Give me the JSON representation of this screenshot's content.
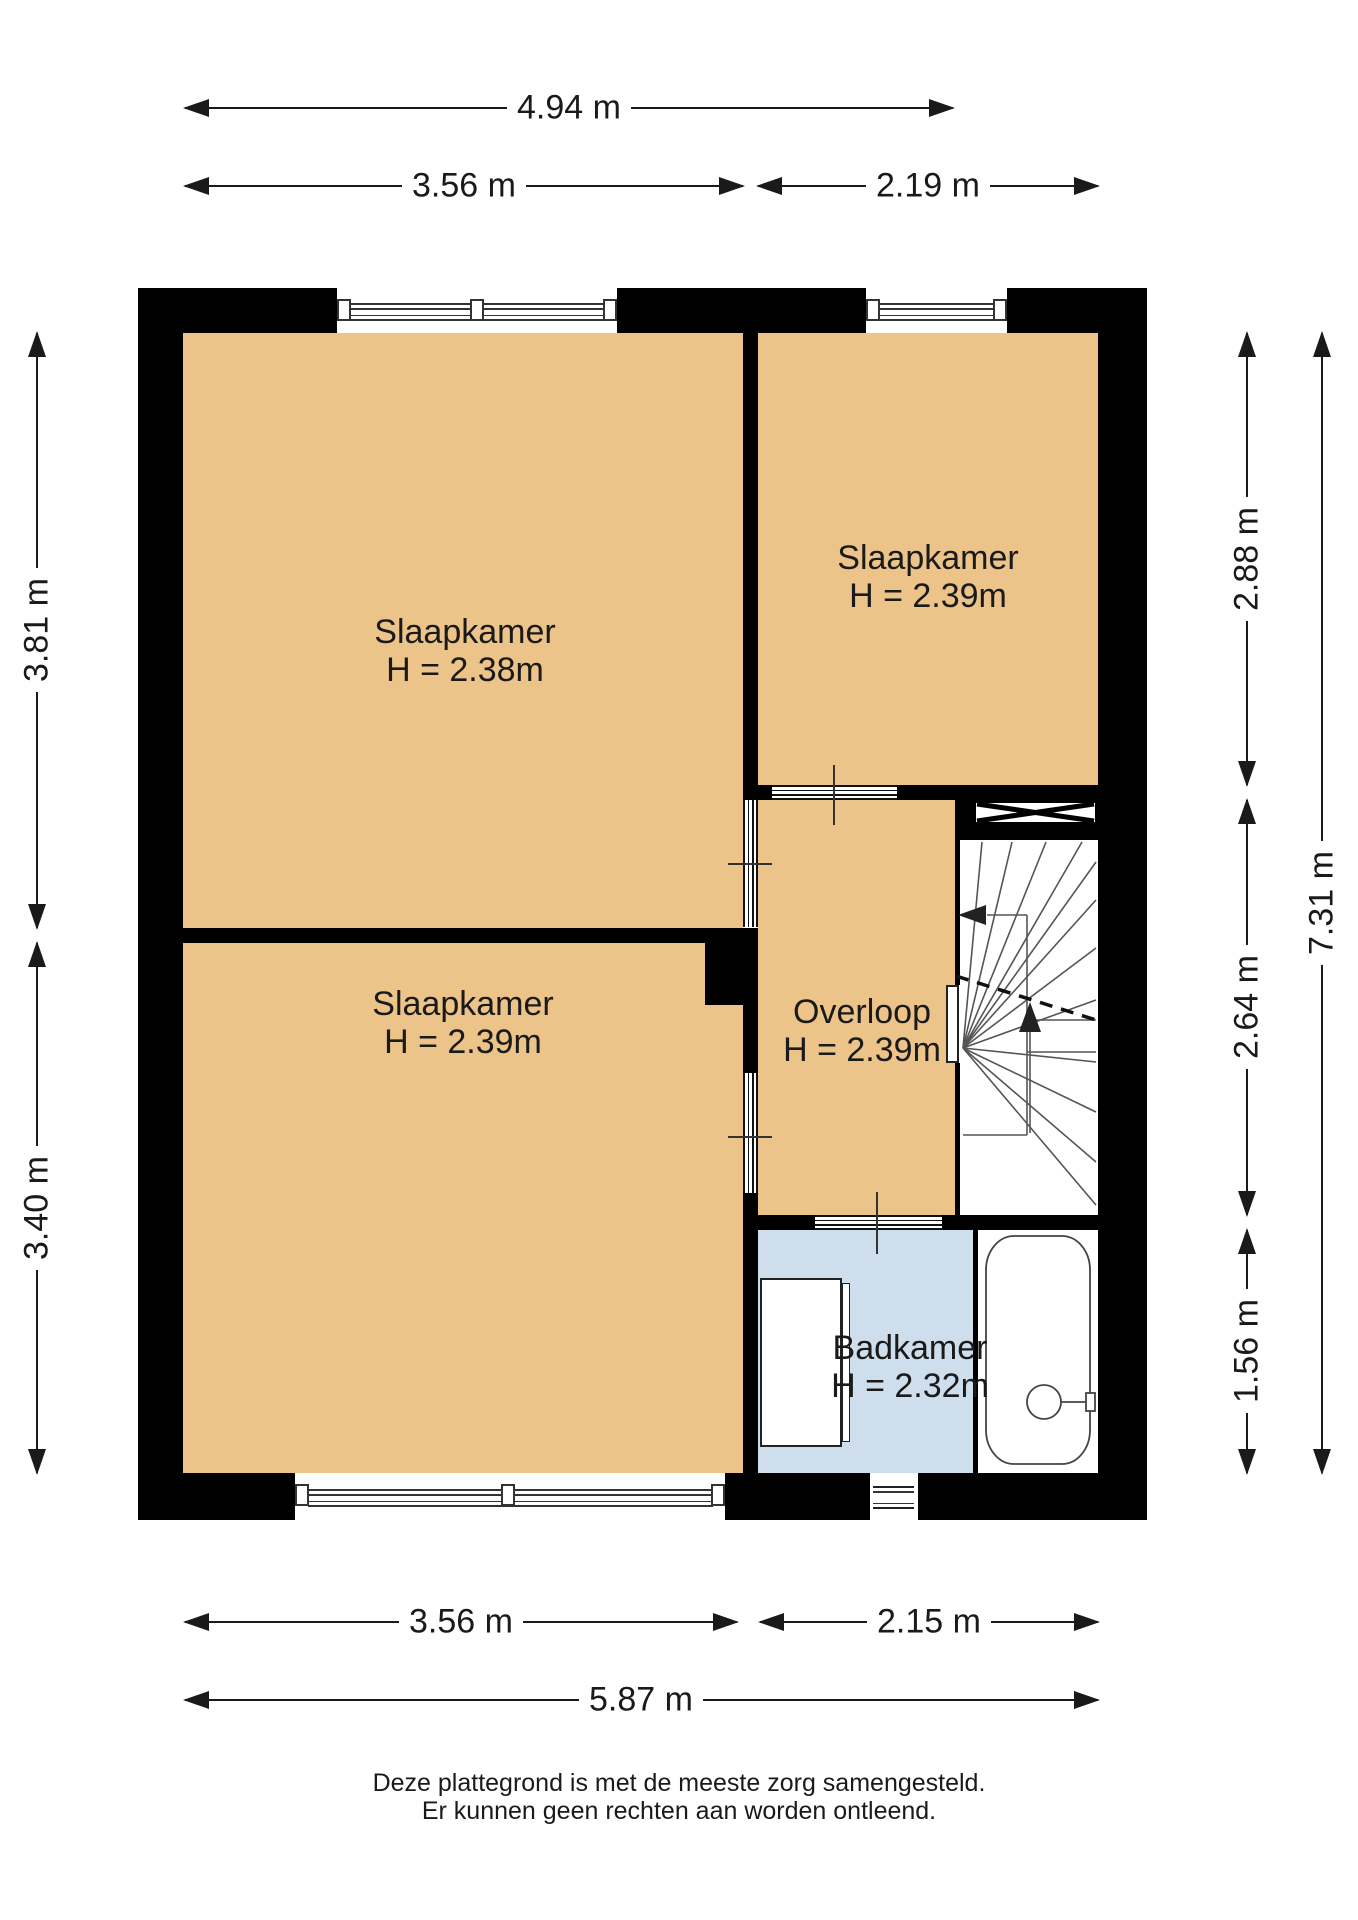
{
  "title": "Verdieping plattegrond",
  "colors": {
    "room_fill": "#ecc388",
    "bathroom_fill": "#cfdeed",
    "wall": "#000000",
    "fixture_line": "#444444",
    "dimension_line": "#1a1a1a"
  },
  "rooms": {
    "bedroom_top_left": {
      "name": "Slaapkamer",
      "height": "H = 2.38m"
    },
    "bedroom_top_right": {
      "name": "Slaapkamer",
      "height": "H = 2.39m"
    },
    "bedroom_bottom_left": {
      "name": "Slaapkamer",
      "height": "H = 2.39m"
    },
    "landing": {
      "name": "Overloop",
      "height": "H = 2.39m"
    },
    "bathroom": {
      "name": "Badkamer",
      "height": "H = 2.32m"
    }
  },
  "dimensions": {
    "top_overall": "4.94 m",
    "top_left": "3.56 m",
    "top_right": "2.19 m",
    "left_upper": "3.81 m",
    "left_lower": "3.40 m",
    "right_upper": "2.88 m",
    "right_middle": "2.64 m",
    "right_lower": "1.56 m",
    "right_overall": "7.31 m",
    "bottom_left": "3.56 m",
    "bottom_right": "2.15 m",
    "bottom_overall": "5.87 m"
  },
  "disclaimer": {
    "line1": "Deze plattegrond is met de meeste zorg samengesteld.",
    "line2": "Er kunnen geen rechten aan worden ontleend."
  }
}
